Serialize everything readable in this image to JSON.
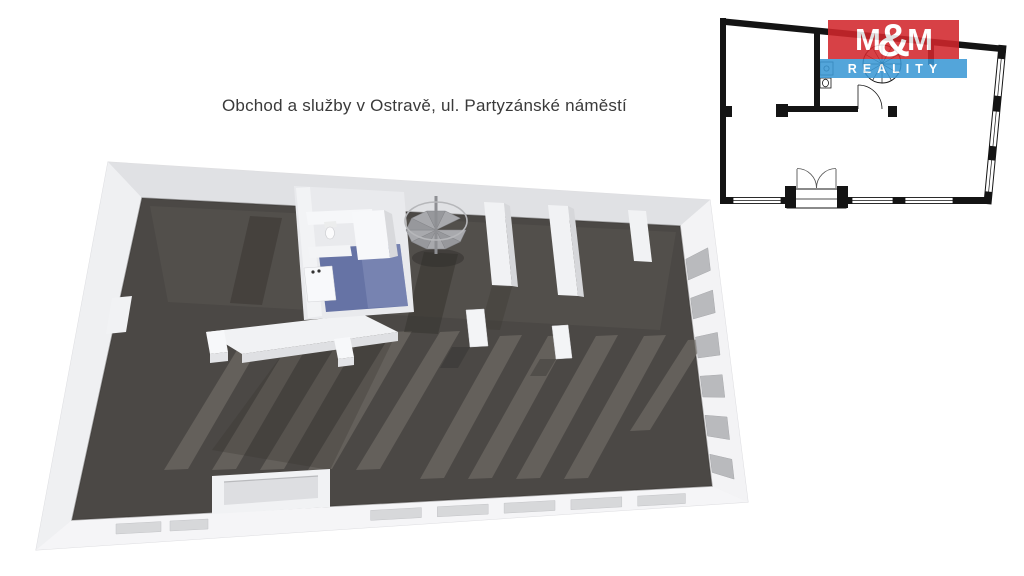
{
  "title": {
    "text": "Obchod a služby v Ostravě, ul. Partyzánské náměstí"
  },
  "logo": {
    "m_left": "M",
    "ampersand": "&",
    "m_right": "M",
    "reality": "REALITY",
    "red": "#d2262b",
    "blue": "#3a98d5",
    "text_color": "#ffffff"
  },
  "colors": {
    "background": "#ffffff",
    "floor_dark": "#4b4845",
    "floor_light_band": "#56534f",
    "floor_stripe": "#6e6a64",
    "floor_shadow": "#37342f",
    "wall_white": "#ececee",
    "wall_face_top": "#e0e1e4",
    "wall_face_left": "#eff0f2",
    "wall_face_right": "#f3f3f5",
    "wall_face_bottom": "#f5f5f7",
    "bathroom_floor": "#6673a5",
    "bathroom_floor_light": "#8b96c0",
    "window_pane_front": "#d7d8da",
    "window_pane_side": "#b9babd",
    "stair_gray": "#a0a1a5",
    "plan_line": "#141414",
    "title_color": "#3a3a3a"
  },
  "floorplan_3d": {
    "features": [
      "shop-floor",
      "spiral-staircase",
      "sanitary-rooms",
      "entrance-recess",
      "storefront-windows",
      "side-windows",
      "columns",
      "low-partition"
    ]
  },
  "floorplan_2d": {
    "features": [
      "outline-walls",
      "storefront-windows",
      "double-entrance-door",
      "spiral-staircase",
      "wc-fixtures",
      "interior-walls"
    ]
  }
}
